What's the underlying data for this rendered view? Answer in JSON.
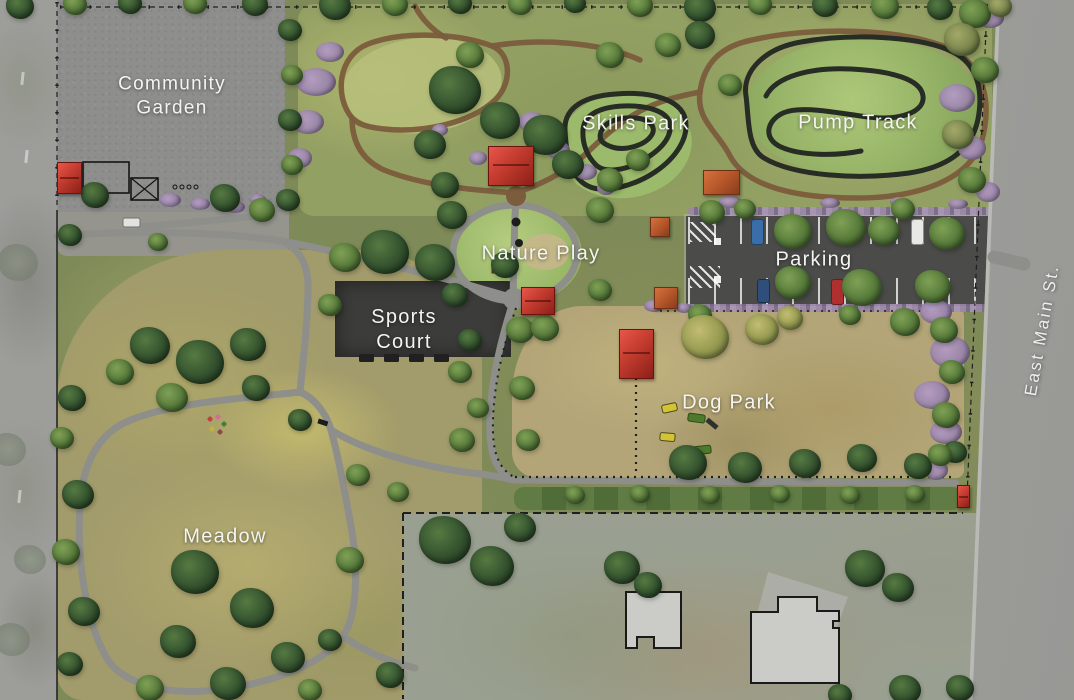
{
  "plan": {
    "areas": {
      "community_garden": {
        "label": "Community Garden"
      },
      "skills_park": {
        "label": "Skills Park"
      },
      "pump_track": {
        "label": "Pump Track"
      },
      "nature_play": {
        "label": "Nature Play"
      },
      "parking": {
        "label": "Parking"
      },
      "sports_court": {
        "label": "Sports Court"
      },
      "dog_park": {
        "label": "Dog Park"
      },
      "meadow": {
        "label": "Meadow"
      }
    },
    "streets": {
      "east_main": {
        "label": "East Main St."
      }
    },
    "colors": {
      "shelter_red": "#c23b2e",
      "track_dark": "#272c24",
      "trail_brown": "#7b5c3c",
      "path_gray": "#8e8e8a",
      "asphalt": "#4b4b49",
      "court": "#3c3c3a",
      "shrub_purple": "#9b86ab"
    }
  }
}
